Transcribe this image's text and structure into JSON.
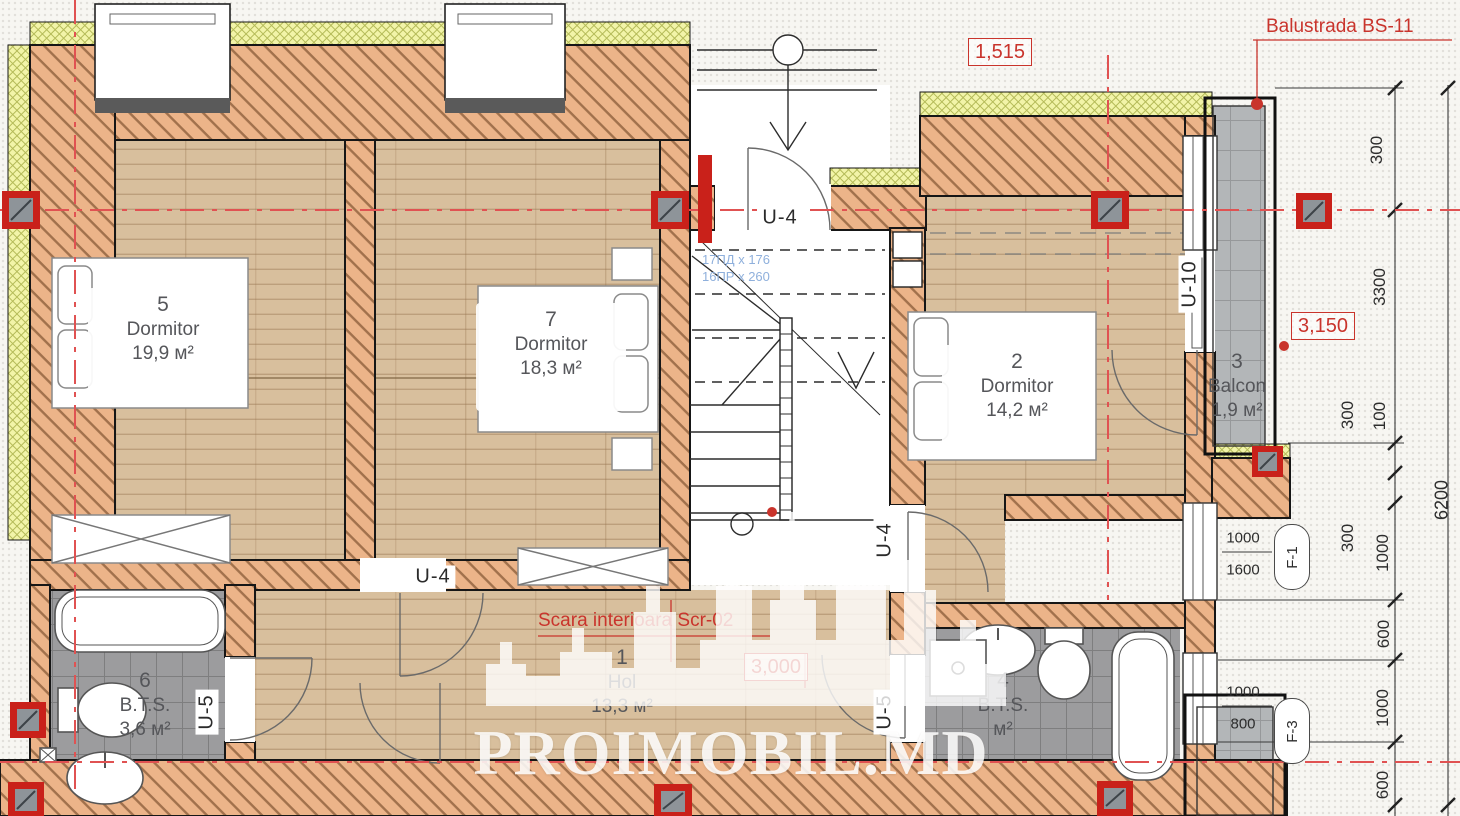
{
  "watermark": {
    "brand": "PROIMOBIL.MD"
  },
  "annotations": {
    "balustrade_label": "Balustrada BS-11",
    "stair_label": "Scara interioara Scr-02",
    "stair_note_line1": "17ПД x 176",
    "stair_note_line2": "16ПР x 260"
  },
  "level_marks": {
    "entry": "1,515",
    "balcony": "3,150",
    "hol": "3,000"
  },
  "rooms": {
    "dormitor5": {
      "number": "5",
      "name": "Dormitor",
      "area": "19,9 м²"
    },
    "dormitor7": {
      "number": "7",
      "name": "Dormitor",
      "area": "18,3 м²"
    },
    "dormitor2": {
      "number": "2",
      "name": "Dormitor",
      "area": "14,2 м²"
    },
    "balcon3": {
      "number": "3",
      "name": "Balcon",
      "area": "1,9 м²"
    },
    "hol1": {
      "number": "1",
      "name": "Hol",
      "area": "13,3 м²"
    },
    "bts6": {
      "number": "6",
      "name": "B.T.S.",
      "area": "3,6 м²"
    },
    "bts4": {
      "number": "4",
      "name": "B.T.S.",
      "area": "м²"
    }
  },
  "doors": {
    "u4": "U-4",
    "u5": "U-5",
    "u10": "U-10"
  },
  "windows": {
    "f1": {
      "label": "F-1",
      "width": "1000",
      "height": "1600"
    },
    "f3": {
      "label": "F-3",
      "width": "1000",
      "height": "800"
    }
  },
  "dimensions": {
    "a300": "300",
    "a3300": "3300",
    "b300": "300",
    "b100": "100",
    "c300": "300",
    "c1000": "1000",
    "d600": "600",
    "e1000": "1000",
    "f600": "600",
    "total": "6200"
  },
  "colors": {
    "accent_red": "#c9342c",
    "wall_fill": "#ecb489",
    "insulation": "#f2f4a8",
    "tile_gray": "#9c9c9e",
    "wood": "#d8bf9d",
    "note_blue": "#8fb0dc"
  }
}
